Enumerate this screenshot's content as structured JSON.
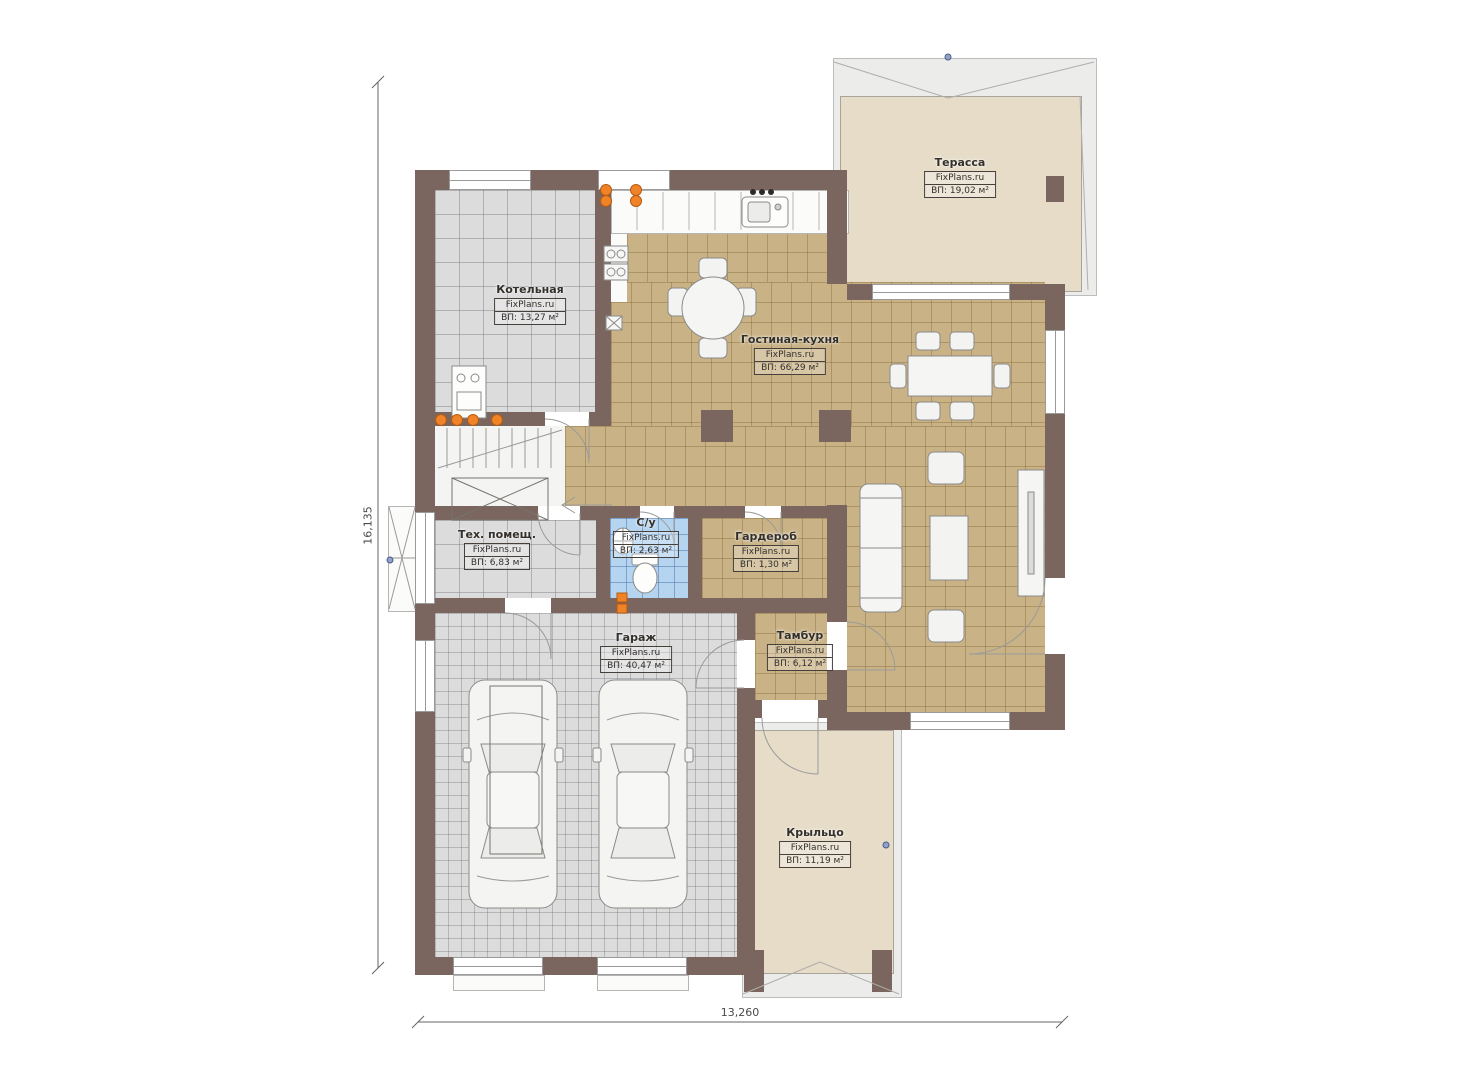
{
  "plan": {
    "brand": "FixPlans.ru",
    "rooms": [
      {
        "key": "terrace",
        "name": "Терасса",
        "area": "ВП: 19,02 м²"
      },
      {
        "key": "boiler",
        "name": "Котельная",
        "area": "ВП: 13,27 м²"
      },
      {
        "key": "living-kitchen",
        "name": "Гостиная-кухня",
        "area": "ВП: 66,29 м²"
      },
      {
        "key": "tech",
        "name": "Тех. помещ.",
        "area": "ВП: 6,83 м²"
      },
      {
        "key": "bathroom",
        "name": "С/у",
        "area": "ВП: 2,63 м²"
      },
      {
        "key": "wardrobe",
        "name": "Гардероб",
        "area": "ВП: 1,30 м²"
      },
      {
        "key": "garage",
        "name": "Гараж",
        "area": "ВП: 40,47 м²"
      },
      {
        "key": "vestibule",
        "name": "Тамбур",
        "area": "ВП: 6,12 м²"
      },
      {
        "key": "porch",
        "name": "Крыльцо",
        "area": "ВП: 11,19 м²"
      }
    ],
    "dimensions": {
      "vertical": "16,135",
      "horizontal": "13,260"
    },
    "colors": {
      "wall": "#7a665e",
      "floor_tile_tan": "#c9b285",
      "floor_tile_gray": "#dcdcdd",
      "floor_tile_blue": "#b5d4f0",
      "deck": "#e6dcc8",
      "roof_band": "#ececea",
      "radiator_orange": "#f08228"
    }
  }
}
